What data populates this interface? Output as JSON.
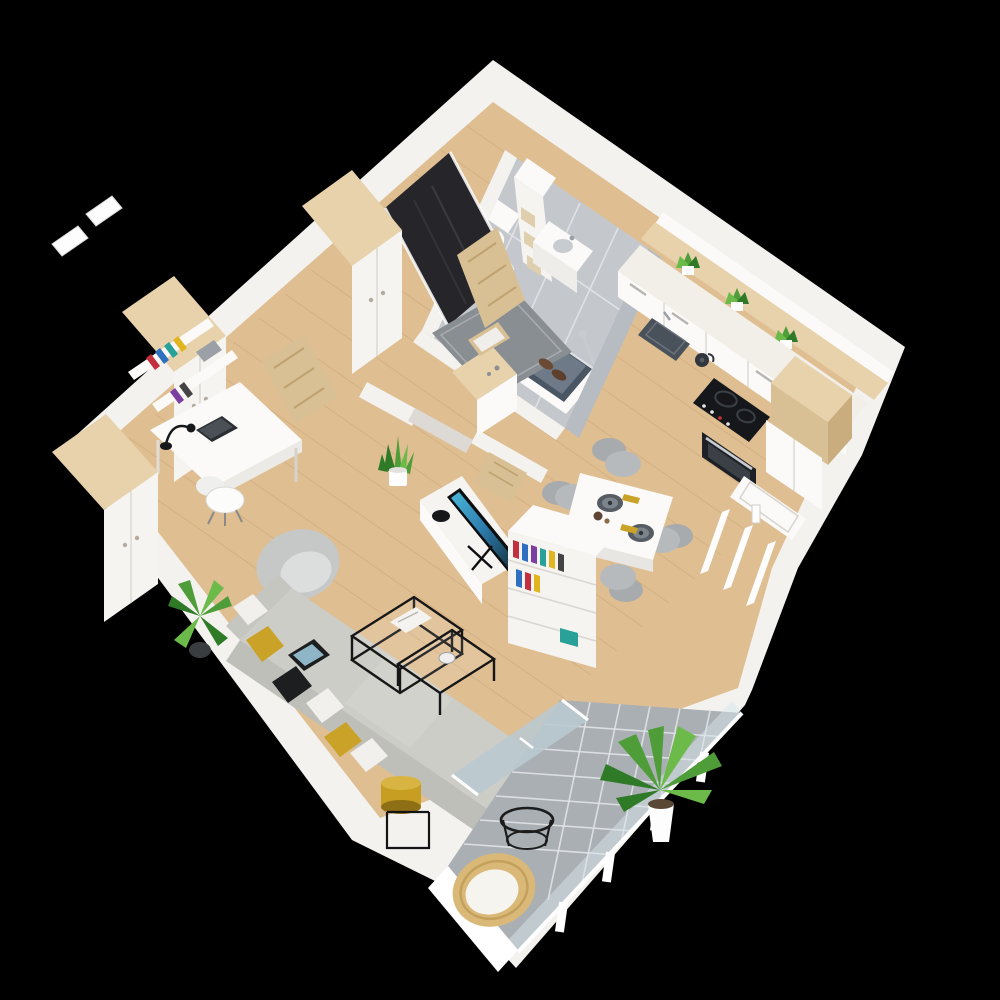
{
  "title": "3D isometric cutaway floor plan render of a studio apartment on a black background",
  "render": {
    "view": "top-down isometric 3D",
    "background": "black",
    "floor_material": "light wood planks"
  },
  "rooms": [
    {
      "name": "entrance-hall",
      "items": [
        "dark front door",
        "gray doormat",
        "pair of shoes",
        "wardrobe with wood top",
        "open interior door",
        "console with mirror"
      ]
    },
    {
      "name": "bathroom",
      "items": [
        "toilet",
        "white storage column with baskets",
        "vanity sink",
        "bathtub",
        "shower fixture",
        "gray tile floor",
        "wooden bathroom door"
      ]
    },
    {
      "name": "kitchen",
      "items": [
        "white counter run",
        "dark sink",
        "kettle",
        "black cooktop",
        "oven",
        "tall white cabinet",
        "wooden worktop block",
        "ledge with plants"
      ]
    },
    {
      "name": "dining-area",
      "items": [
        "white table",
        "gray chairs",
        "dark plates",
        "yellow napkins"
      ]
    },
    {
      "name": "living-room",
      "items": [
        "gray corner sofa",
        "pillows",
        "tablet",
        "nesting black coffee tables",
        "gray armchair",
        "yellow floor lamp",
        "palm plant",
        "tv sideboard",
        "flat tv",
        "white bookshelf",
        "snake plant",
        "half-wall partition"
      ]
    },
    {
      "name": "workspace",
      "items": [
        "white desk",
        "white chair",
        "laptop",
        "desk lamp",
        "wall shelves with books",
        "two wardrobes"
      ]
    },
    {
      "name": "balcony",
      "items": [
        "gray tile floor",
        "glass railing with white posts",
        "large potted palm",
        "round metal side table",
        "wicker chair with white cushion",
        "sliding glass door"
      ]
    }
  ],
  "counts": {
    "kitchen_ledge_plants": 3,
    "dining_chairs": 4,
    "place_settings": 2,
    "sofa_pillows": 6,
    "wardrobes": 3,
    "coffee_tables": 2
  },
  "palette": {
    "bg": "#000000",
    "wall": "#f3f2ef",
    "wall-shade": "#ddd9d4",
    "wood": "#dfbe92",
    "wood-grain": "#c8a271",
    "wood-light": "#e7d2ab",
    "wood-mid": "#d9c094",
    "wood-dark": "#c9ad7e",
    "tile-bath": "#c4c8cd",
    "tile-balcony": "#a9afb3",
    "grout": "#e2e5e7",
    "white": "#fbfaf8",
    "panel": "#f6f4f1",
    "sofa": "#cdcdc8",
    "sofa-dark": "#bfbfba",
    "cushion": "#f1f0ec",
    "mustard": "#c9a227",
    "mustard-deep": "#9c7d12",
    "plant": "#4f9d38",
    "plant-dark": "#2f7a26",
    "plant-light": "#6cbb4a",
    "metal": "#161616",
    "appliance": "#15171a",
    "steel": "#c8ccd0",
    "chair-gray": "#b7babc",
    "plate": "#565c63",
    "mat": "#898e93",
    "door-dark": "#26262a",
    "glass": "#b9c9d0",
    "tub": "#4a5664",
    "book-colors": [
      "#c22f3f",
      "#2e6fbf",
      "#7a3fa0",
      "#2aa198",
      "#e0b520",
      "#444444"
    ]
  }
}
